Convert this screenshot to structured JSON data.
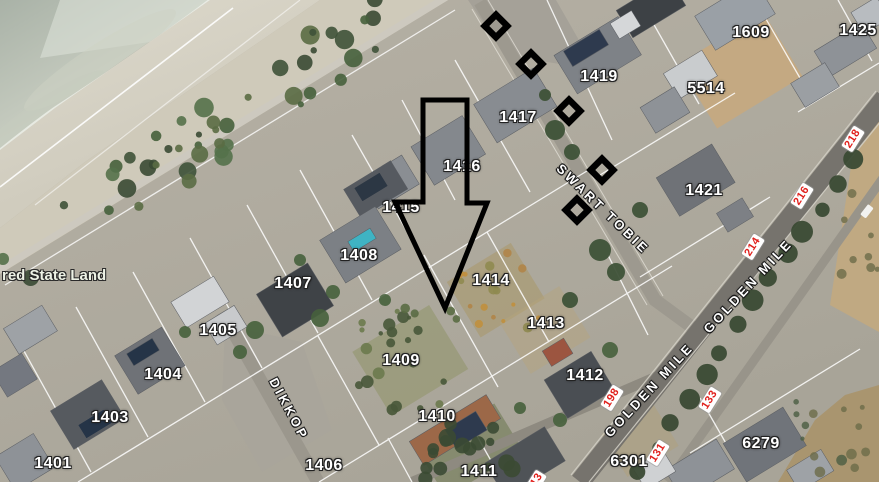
{
  "map": {
    "type": "aerial-cadastral-map",
    "colors": {
      "parcel_text": "#ffffff",
      "street_text": "#ffffff",
      "route_number_text": "#e0201c",
      "annotation": "#000000"
    },
    "parcel_labels": [
      {
        "text": "1609",
        "x": 751,
        "y": 33
      },
      {
        "text": "1425",
        "x": 858,
        "y": 31
      },
      {
        "text": "1419",
        "x": 599,
        "y": 77
      },
      {
        "text": "5514",
        "x": 706,
        "y": 89
      },
      {
        "text": "1417",
        "x": 518,
        "y": 118
      },
      {
        "text": "1416",
        "x": 462,
        "y": 167
      },
      {
        "text": "1421",
        "x": 704,
        "y": 191
      },
      {
        "text": "1415",
        "x": 401,
        "y": 208
      },
      {
        "text": "1408",
        "x": 359,
        "y": 256
      },
      {
        "text": "1414",
        "x": 491,
        "y": 281
      },
      {
        "text": "1407",
        "x": 293,
        "y": 284
      },
      {
        "text": "1413",
        "x": 546,
        "y": 324
      },
      {
        "text": "1405",
        "x": 218,
        "y": 331
      },
      {
        "text": "1409",
        "x": 401,
        "y": 361
      },
      {
        "text": "1404",
        "x": 163,
        "y": 375
      },
      {
        "text": "1412",
        "x": 585,
        "y": 376
      },
      {
        "text": "1403",
        "x": 110,
        "y": 418
      },
      {
        "text": "1410",
        "x": 437,
        "y": 417
      },
      {
        "text": "6301",
        "x": 629,
        "y": 462
      },
      {
        "text": "6279",
        "x": 761,
        "y": 444
      },
      {
        "text": "1401",
        "x": 53,
        "y": 464
      },
      {
        "text": "1406",
        "x": 324,
        "y": 466
      },
      {
        "text": "1411",
        "x": 479,
        "y": 472
      }
    ],
    "street_labels": [
      {
        "text": "SWART TOBIE",
        "x": 603,
        "y": 209,
        "angle": 44
      },
      {
        "text": "GOLDEN MILE",
        "x": 748,
        "y": 286,
        "angle": -47
      },
      {
        "text": "GOLDEN MILE",
        "x": 649,
        "y": 390,
        "angle": -47
      },
      {
        "text": "DIKKOP",
        "x": 289,
        "y": 409,
        "angle": 62
      }
    ],
    "route_markers": [
      {
        "text": "218",
        "x": 853,
        "y": 139,
        "angle": -58
      },
      {
        "text": "216",
        "x": 802,
        "y": 196,
        "angle": -58
      },
      {
        "text": "214",
        "x": 753,
        "y": 247,
        "angle": -58
      },
      {
        "text": "198",
        "x": 612,
        "y": 398,
        "angle": -58
      },
      {
        "text": "133",
        "x": 710,
        "y": 400,
        "angle": -58
      },
      {
        "text": "131",
        "x": 658,
        "y": 453,
        "angle": -58
      },
      {
        "text": "13",
        "x": 537,
        "y": 480,
        "angle": -58
      }
    ],
    "area_labels": [
      {
        "text": "red State Land",
        "x": 2,
        "y": 276
      }
    ],
    "annotations": {
      "arrow_icon": "down-arrow-outline",
      "diamond_markers": [
        {
          "x": 496,
          "y": 26
        },
        {
          "x": 531,
          "y": 64
        },
        {
          "x": 569,
          "y": 111
        },
        {
          "x": 602,
          "y": 170
        },
        {
          "x": 577,
          "y": 210
        }
      ]
    }
  }
}
